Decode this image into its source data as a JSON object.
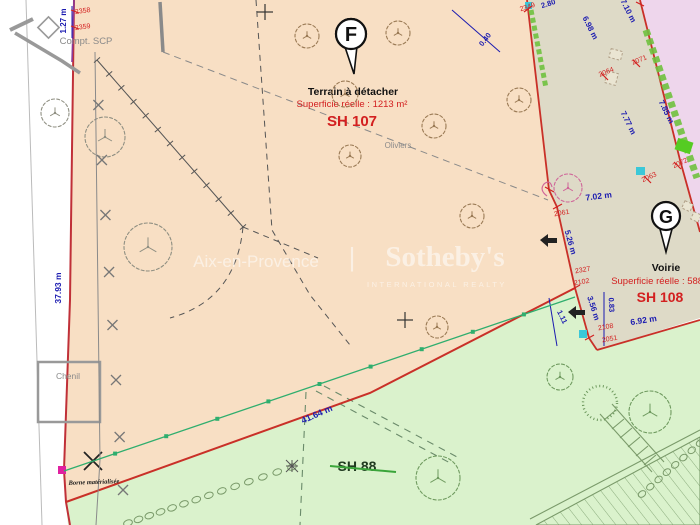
{
  "watermark": {
    "city": "Aix-en-Provence",
    "separator": "|",
    "brand": "Sotheby's",
    "subbrand": "INTERNATIONAL REALTY"
  },
  "parcels": [
    {
      "marker": "F",
      "name": "Terrain à détacher",
      "area": "Superficie réelle : 1213 m²",
      "id": "SH 107"
    },
    {
      "marker": "G",
      "name": "Voirie",
      "area": "Superficie réelle : 588 m²",
      "id": "SH 108"
    },
    {
      "marker": "",
      "name": "",
      "area": "",
      "id": "SH 88"
    }
  ],
  "colors": {
    "blue": "#1b1bb0",
    "red": "#d32020",
    "boundary": "#c03038",
    "violet": "#8a3a9a",
    "gray": "#8a8a8a",
    "black": "#1a1a1a",
    "green_line": "#2fae6e",
    "parcel_peach": "#f8dfc4",
    "parcel_green": "#daf2cc",
    "road": "#dedac7",
    "pink": "#eed6ec",
    "hedge": "#6fc13e",
    "cyan": "#3bc8d8",
    "magenta": "#e020a0"
  },
  "annotations": [
    {
      "t": "1.27 m",
      "x": 66,
      "y": 21,
      "r": -90,
      "s": 8,
      "c": "blue",
      "w": "bold",
      "n": "dim-1-27-m"
    },
    {
      "t": "2358",
      "x": 83,
      "y": 13,
      "r": -8,
      "s": 7,
      "c": "red",
      "n": "point-2358"
    },
    {
      "t": "2359",
      "x": 83,
      "y": 29,
      "r": -8,
      "s": 7,
      "c": "red",
      "n": "point-2359"
    },
    {
      "t": "Compt. SCP",
      "x": 86,
      "y": 44,
      "s": 9.5,
      "c": "gray",
      "n": "label-compt-scp"
    },
    {
      "t": "2349",
      "x": 528,
      "y": 9,
      "r": -18,
      "s": 7,
      "c": "red",
      "n": "point-2349"
    },
    {
      "t": "2.80",
      "x": 549,
      "y": 6,
      "r": -18,
      "s": 7.5,
      "c": "blue",
      "w": "bold",
      "n": "dim-2-80"
    },
    {
      "t": "0.40",
      "x": 487,
      "y": 41,
      "r": -52,
      "s": 7.5,
      "c": "blue",
      "w": "bold",
      "n": "dim-0-40"
    },
    {
      "t": "6.98 m",
      "x": 588,
      "y": 29,
      "r": 63,
      "s": 8,
      "c": "blue",
      "w": "bold",
      "n": "dim-6-98-m"
    },
    {
      "t": "7.10 m",
      "x": 626,
      "y": 12,
      "r": 63,
      "s": 8,
      "c": "blue",
      "w": "bold",
      "n": "dim-7-10-m"
    },
    {
      "t": "2064",
      "x": 607,
      "y": 74,
      "r": -22,
      "s": 7,
      "c": "red",
      "n": "point-2064"
    },
    {
      "t": "2071",
      "x": 640,
      "y": 62,
      "r": -22,
      "s": 7,
      "c": "red",
      "n": "point-2071"
    },
    {
      "t": "7.77 m",
      "x": 626,
      "y": 124,
      "r": 64,
      "s": 8,
      "c": "blue",
      "w": "bold",
      "n": "dim-7-77-m"
    },
    {
      "t": "7.85 m",
      "x": 664,
      "y": 113,
      "r": 64,
      "s": 8,
      "c": "blue",
      "w": "bold",
      "n": "dim-7-85-m"
    },
    {
      "t": "2063",
      "x": 650,
      "y": 179,
      "r": -25,
      "s": 7,
      "c": "red",
      "n": "point-2063"
    },
    {
      "t": "2072",
      "x": 681,
      "y": 165,
      "r": -25,
      "s": 7,
      "c": "red",
      "n": "point-2072"
    },
    {
      "t": "2061",
      "x": 562,
      "y": 215,
      "r": -10,
      "s": 7,
      "c": "red",
      "n": "point-2061"
    },
    {
      "t": "7.02 m",
      "x": 599,
      "y": 199,
      "r": -7,
      "s": 8.5,
      "c": "blue",
      "w": "bold",
      "n": "dim-7-02-m"
    },
    {
      "t": "5.26 m",
      "x": 568,
      "y": 243,
      "r": 74,
      "s": 8,
      "c": "blue",
      "w": "bold",
      "n": "dim-5-26-m"
    },
    {
      "t": "2327",
      "x": 583,
      "y": 272,
      "r": -10,
      "s": 7,
      "c": "red",
      "n": "point-2327"
    },
    {
      "t": "2102",
      "x": 582,
      "y": 284,
      "r": -10,
      "s": 7,
      "c": "red",
      "n": "point-2102"
    },
    {
      "t": "3.56 m",
      "x": 591,
      "y": 309,
      "r": 72,
      "s": 8,
      "c": "blue",
      "w": "bold",
      "n": "dim-3-56-m"
    },
    {
      "t": "0.83",
      "x": 609,
      "y": 305,
      "r": 87,
      "s": 7.5,
      "c": "blue",
      "w": "bold",
      "n": "dim-0-83"
    },
    {
      "t": "1.11",
      "x": 560,
      "y": 318,
      "r": 64,
      "s": 7.5,
      "c": "blue",
      "w": "bold",
      "n": "dim-1-11"
    },
    {
      "t": "2108",
      "x": 606,
      "y": 329,
      "r": -10,
      "s": 7,
      "c": "red",
      "n": "point-2108"
    },
    {
      "t": "2051",
      "x": 610,
      "y": 341,
      "r": -10,
      "s": 7,
      "c": "red",
      "n": "point-2051"
    },
    {
      "t": "6.92 m",
      "x": 644,
      "y": 323,
      "r": -9,
      "s": 8.5,
      "c": "blue",
      "w": "bold",
      "n": "dim-6-92-m"
    },
    {
      "t": "Oliviers",
      "x": 398,
      "y": 148,
      "s": 8,
      "c": "gray",
      "n": "label-oliviers"
    },
    {
      "t": "37.93 m",
      "x": 61,
      "y": 288,
      "r": -90,
      "s": 8.5,
      "c": "blue",
      "w": "bold",
      "n": "dim-37-93-m"
    },
    {
      "t": "Chenil",
      "x": 68,
      "y": 379,
      "s": 8.5,
      "c": "gray",
      "n": "label-chenil"
    },
    {
      "t": "41.64 m",
      "x": 318,
      "y": 417,
      "r": -24,
      "s": 9,
      "c": "blue",
      "w": "bold",
      "n": "dim-41-64-m"
    },
    {
      "t": "Borne matérialisée",
      "x": 94,
      "y": 484,
      "r": -2,
      "s": 6.5,
      "c": "black",
      "w": "bold",
      "i": true,
      "f": "serif",
      "n": "label-borne-materialisee"
    }
  ]
}
